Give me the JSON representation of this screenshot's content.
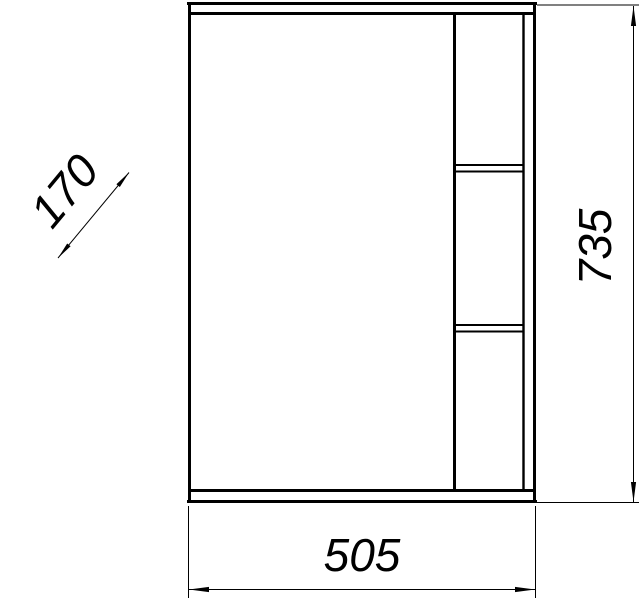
{
  "drawing": {
    "colors": {
      "line": "#000000",
      "background": "#ffffff"
    },
    "dimensions": {
      "width_mm": "505",
      "height_mm": "735",
      "depth_mm": "170"
    }
  }
}
